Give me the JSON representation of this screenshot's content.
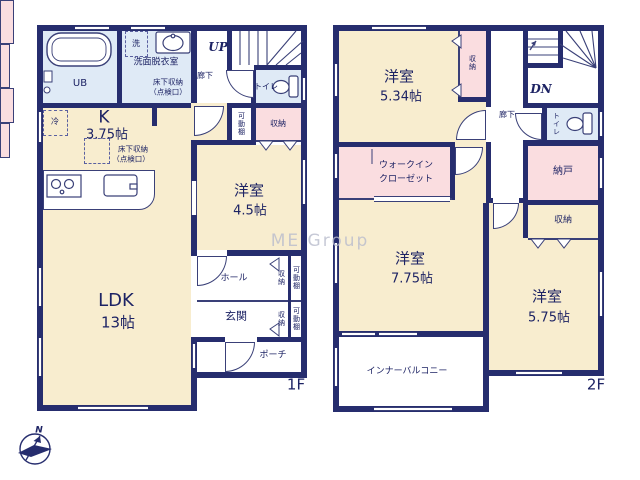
{
  "watermark": "ME Group",
  "compass": {
    "north": "N"
  },
  "colors": {
    "wall": "#262d6e",
    "room_cream": "#f8edcf",
    "storage_pink": "#fadde0",
    "wet_blue": "#dfeaf6",
    "text_navy": "#1d2364"
  },
  "floor1": {
    "floor_label": "1F",
    "bath": {
      "ub": "UB"
    },
    "washroom": {
      "name": "洗面脱衣室",
      "washer": "洗",
      "underfloor_line1": "床下収納",
      "underfloor_line2": "（点検口）"
    },
    "corridor": "廊下",
    "stairs_up": "UP",
    "toilet": "トイレ",
    "kitchen": {
      "name": "K",
      "size": "3.75帖",
      "fridge": "冷",
      "underfloor_line1": "床下収納",
      "underfloor_line2": "（点検口）"
    },
    "shelf_upper": "可動棚",
    "closet_upper": "収納",
    "west_room": {
      "name": "洋室",
      "size": "4.5帖"
    },
    "ldk": {
      "name": "LDK",
      "size": "13帖"
    },
    "hall": "ホール",
    "entrance": "玄関",
    "porch": "ポーチ",
    "hall_closet": {
      "storage": "収納",
      "shelf": "可動棚"
    },
    "entrance_closet": {
      "storage": "収納",
      "shelf": "可動棚"
    }
  },
  "floor2": {
    "floor_label": "2F",
    "room_534": {
      "name": "洋室",
      "size": "5.34帖",
      "closet": "収納"
    },
    "corridor": "廊下",
    "stairs_down": "DN",
    "toilet": "トイレ",
    "wic": {
      "line1": "ウォークイン",
      "line2": "クローゼット"
    },
    "storeroom": "納戸",
    "closet": "収納",
    "room_775": {
      "name": "洋室",
      "size": "7.75帖"
    },
    "room_575": {
      "name": "洋室",
      "size": "5.75帖"
    },
    "balcony": "インナーバルコニー"
  }
}
